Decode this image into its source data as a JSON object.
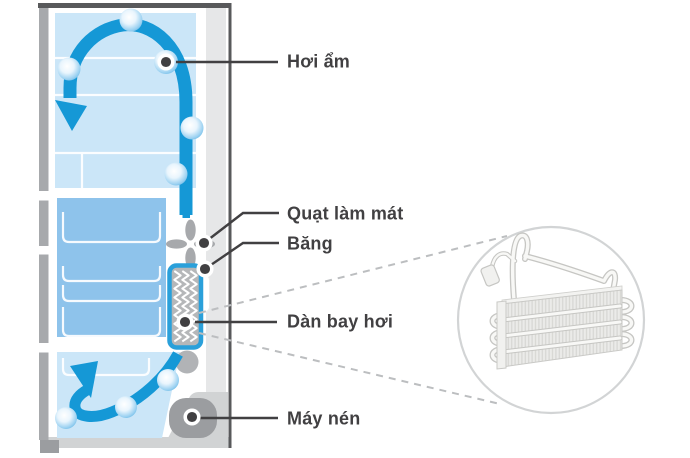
{
  "diagram": {
    "description": "refrigerator-cooling-cycle-cutaway",
    "labels": {
      "moisture": "Hơi ẩm",
      "cooling_fan": "Quạt làm mát",
      "ice": "Băng",
      "evaporator": "Dàn bay hơi",
      "compressor": "Máy nén"
    },
    "icons": {
      "airflow": "airflow-arrow-icon",
      "droplet": "water-droplet-icon",
      "fan": "fan-icon",
      "evaporator": "evaporator-coil-icon",
      "compressor": "compressor-icon",
      "magnifier": "magnifier-circle"
    },
    "colors": {
      "accent_blue": "#1598d6",
      "light_blue": "#cbe6f8",
      "freezer_blue": "#8ec3eb",
      "evaporator_border_blue": "#2aa0da",
      "label_dark": "#414042",
      "frame_gray": "#a7a9ac",
      "frame_dark": "#58595b",
      "wall_gray": "#e6e7e8",
      "dashed_gray": "#bcbec0",
      "compressor_gray": "#9b9da0",
      "bottom_band_gray": "#d1d3d4"
    }
  }
}
